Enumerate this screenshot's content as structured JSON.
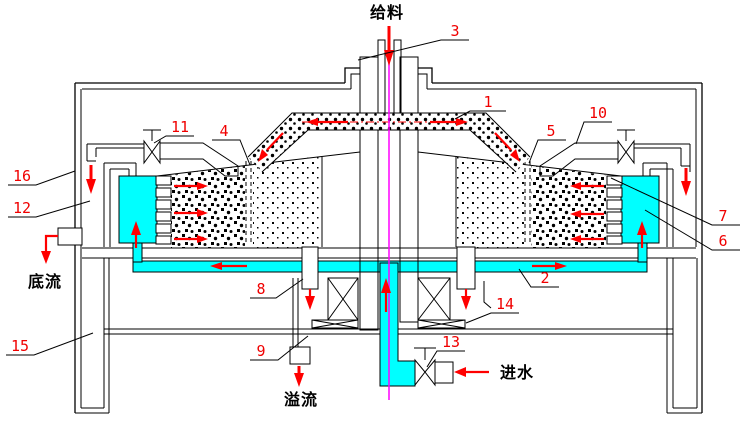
{
  "diagram": {
    "type": "engineering-cross-section",
    "description_visible_text_only": true,
    "flow_labels": {
      "feed": "给料",
      "underflow": "底流",
      "overflow": "溢流",
      "water_inlet": "进水"
    },
    "part_labels": {
      "n1": "1",
      "n2": "2",
      "n3": "3",
      "n4": "4",
      "n5": "5",
      "n6": "6",
      "n7": "7",
      "n8": "8",
      "n9": "9",
      "n10": "10",
      "n11": "11",
      "n12": "12",
      "n13": "13",
      "n14": "14",
      "n15": "15",
      "n16": "16"
    },
    "colors": {
      "water": "#00ffff",
      "flow_arrow": "#ff0000",
      "label_text": "#f00000",
      "centerline": "#ff00ff",
      "line_work": "#000000",
      "background": "#ffffff"
    }
  }
}
